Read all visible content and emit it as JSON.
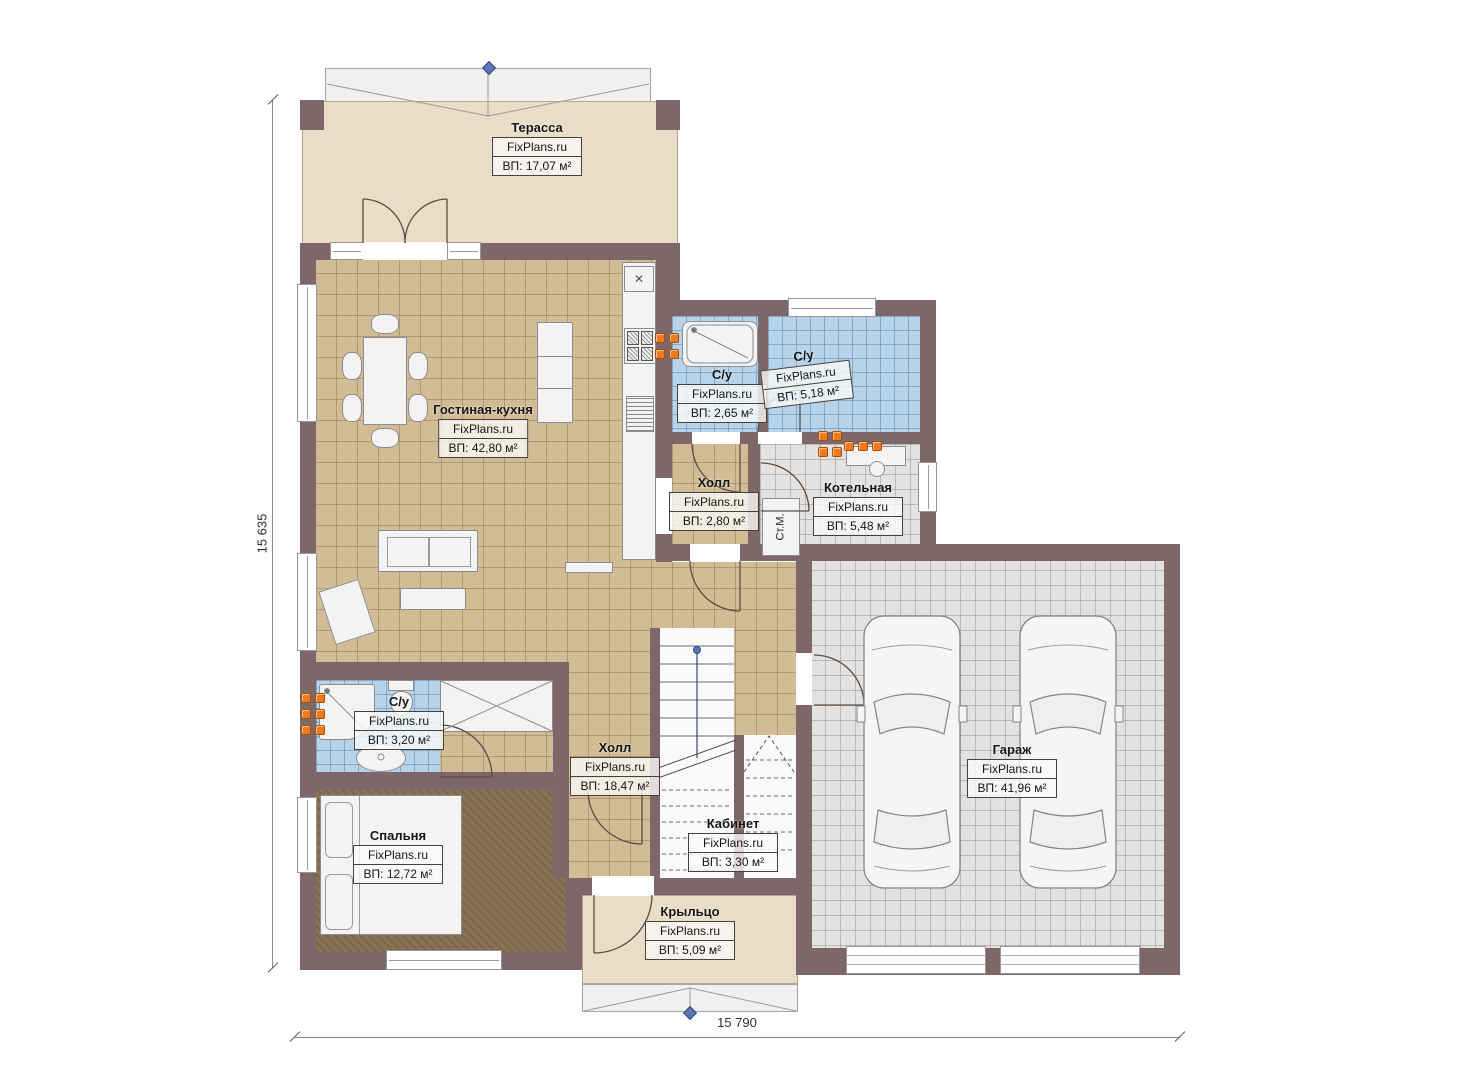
{
  "brand": "FixPlans.ru",
  "plan": {
    "dim_height": "15 635",
    "dim_width": "15 790"
  },
  "rooms": {
    "terrace": {
      "name": "Терасса",
      "area": "ВП: 17,07 м²"
    },
    "living": {
      "name": "Гостиная-кухня",
      "area": "ВП: 42,80 м²"
    },
    "wc_small": {
      "name": "С/у",
      "area": "ВП: 2,65 м²"
    },
    "wc_big": {
      "name": "С/у",
      "area": "ВП: 5,18 м²"
    },
    "hall_small": {
      "name": "Холл",
      "area": "ВП: 2,80 м²"
    },
    "boiler": {
      "name": "Котельная",
      "area": "ВП: 5,48 м²"
    },
    "wc_lower": {
      "name": "С/у",
      "area": "ВП: 3,20 м²"
    },
    "hall_main": {
      "name": "Холл",
      "area": "ВП: 18,47 м²"
    },
    "office": {
      "name": "Кабинет",
      "area": "ВП: 3,30 м²"
    },
    "bedroom": {
      "name": "Спальня",
      "area": "ВП: 12,72 м²"
    },
    "porch": {
      "name": "Крыльцо",
      "area": "ВП: 5,09 м²"
    },
    "garage": {
      "name": "Гараж",
      "area": "ВП: 41,96 м²"
    }
  },
  "fixtures": {
    "washing_machine": "Ст.М.",
    "hood_mark": "✕"
  },
  "colors": {
    "wall": "#7d676a",
    "floor_tile": "#d2bc96",
    "wet_tile": "#b7d3ea",
    "tech_tile": "#e3e2e1",
    "terrace_floor": "#e9ddc7",
    "carpet": "#8a7254",
    "radiator": "#f07b1d",
    "marker": "#5d77b5"
  }
}
